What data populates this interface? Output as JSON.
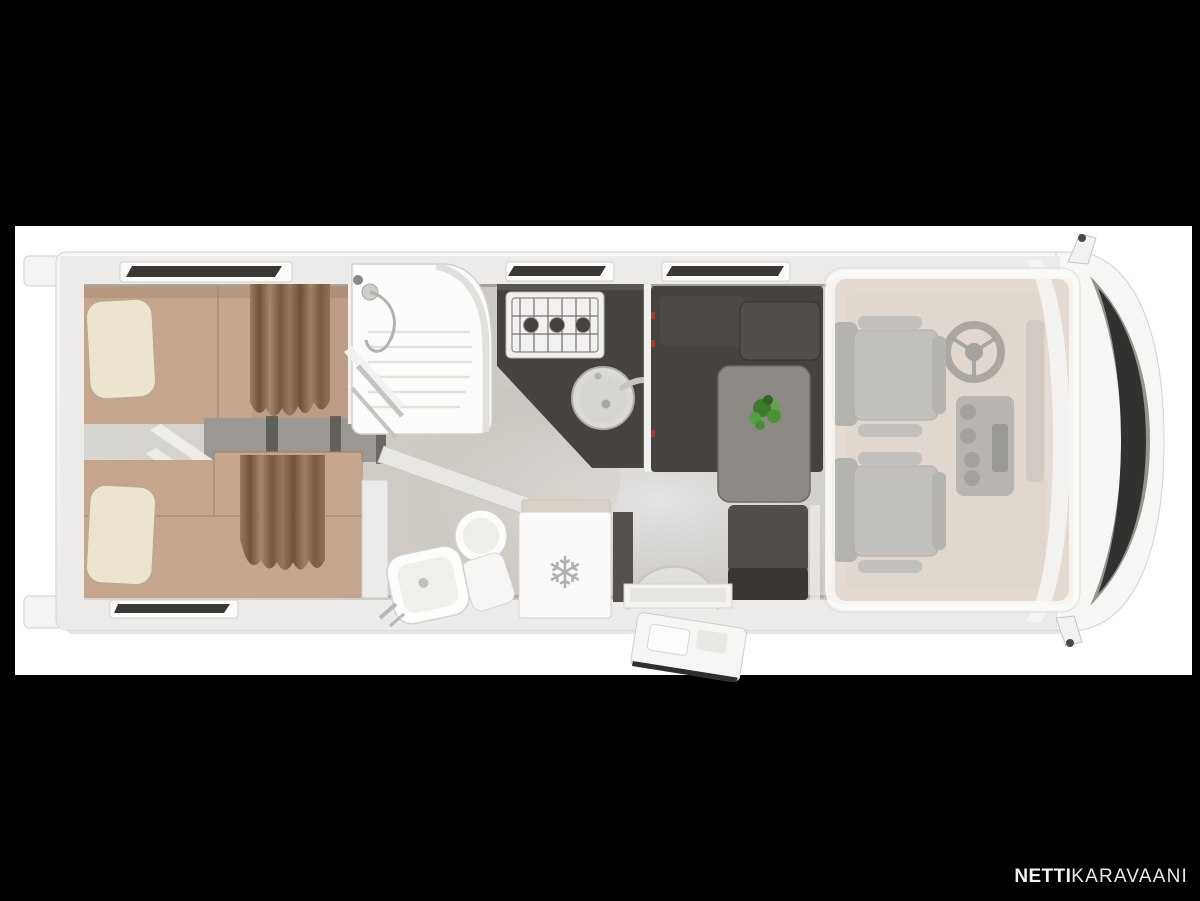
{
  "watermark": {
    "bold": "NETTI",
    "light": "KARAVAANI"
  },
  "icons": {
    "snowflake": "❄"
  },
  "colors": {
    "frame": "#000000",
    "canvas": "#ffffff",
    "body": "#f4f3f1",
    "body_edge": "#d5d2cf",
    "wall": "#ecebe9",
    "mattress": "#c6a58d",
    "mattress_dark": "#ae8d75",
    "pillow": "#ece4d1",
    "pillow_edge": "#b5aa94",
    "steps": "#9c9995",
    "step_slat": "#56534f",
    "counter": "#46433f",
    "hob": "#f2f1ef",
    "burner": "#45423f",
    "sink": "#dcdad7",
    "sofa": "#454240",
    "sofa_cushion": "#524f4b",
    "table": "#8c8985",
    "table_edge": "#6e6b67",
    "plant": "#4a8c36",
    "fixture": "#fbfaf9",
    "fixture_edge": "#d3d1ce",
    "fridge_top": "#d8d1c7",
    "snowflake": "#b3b1ae",
    "cab_floor": "#ccbead",
    "seat": "#8f8c87",
    "seat_dark": "#7a7772",
    "dash": "#6b675f",
    "windshield": "#333130",
    "window": "#3a3835",
    "watermark": "#f2f2f2",
    "red_clip": "#a33b35"
  }
}
